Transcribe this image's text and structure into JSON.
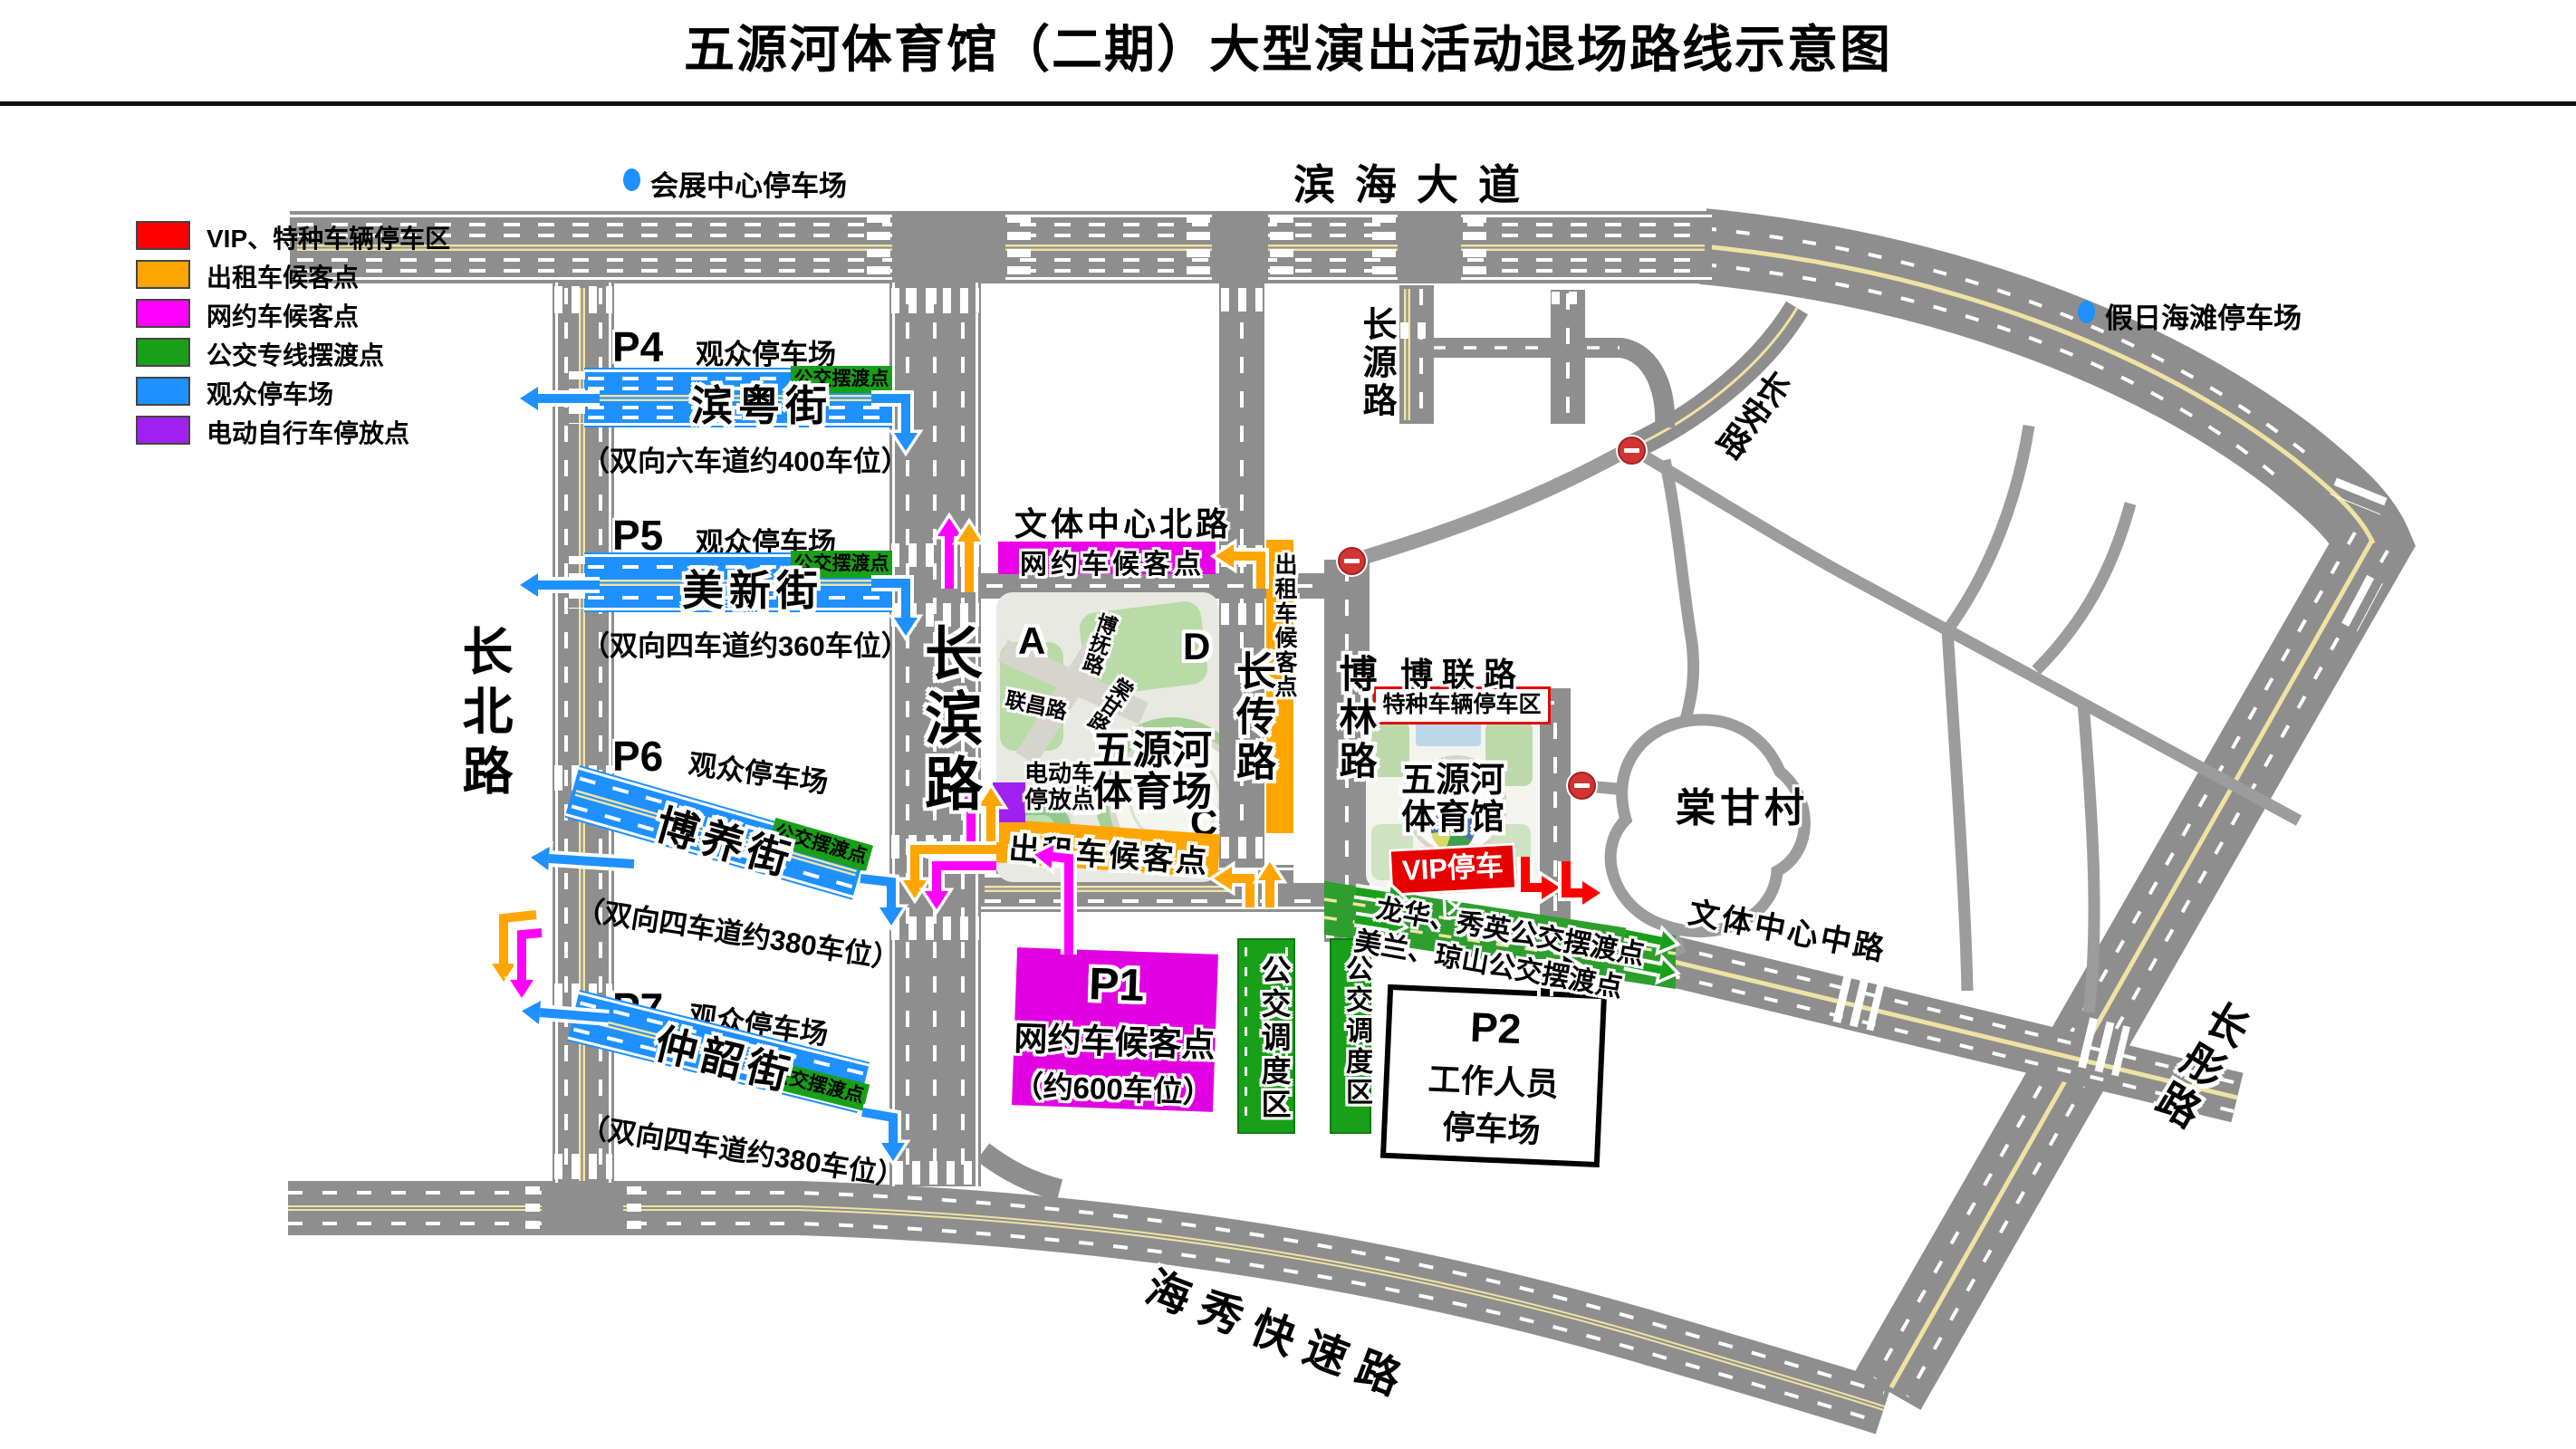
{
  "title": "五源河体育馆（二期）大型演出活动退场路线示意图",
  "colors": {
    "vip_red": "#ff0000",
    "taxi_orange": "#ffa500",
    "ridehail_magenta": "#ff00ff",
    "bus_green": "#18a018",
    "audience_blue": "#1e90ff",
    "ebike_purple": "#a020f0",
    "road_gray": "#8e8e8e"
  },
  "legend": {
    "items": [
      {
        "label": "VIP、特种车辆停车区",
        "color": "#ff0000"
      },
      {
        "label": "出租车候客点",
        "color": "#ffa500"
      },
      {
        "label": "网约车候客点",
        "color": "#ff00ff"
      },
      {
        "label": "公交专线摆渡点",
        "color": "#18a018"
      },
      {
        "label": "观众停车场",
        "color": "#1e90ff"
      },
      {
        "label": "电动自行车停放点",
        "color": "#a020f0"
      }
    ]
  },
  "offsite": {
    "expo": "会展中心停车场",
    "beach": "假日海滩停车场"
  },
  "roads": {
    "binhai": "滨海大道",
    "haixiu": "海秀快速路",
    "changbei": "长北路",
    "changbin": "长滨路",
    "changchuan": "长传路",
    "bolin": "博林路",
    "bolian": "博联路",
    "changyuan": "长源路",
    "changan": "长安路",
    "changtong": "长彤路",
    "wenti_north": "文体中心北路",
    "wenti_mid": "文体中心中路"
  },
  "village": "棠甘村",
  "stadium": {
    "name1": "五源河",
    "name2": "体育场",
    "gate_a": "A",
    "gate_b": "B",
    "gate_c": "C",
    "gate_d": "D",
    "road_bofu": "博抚路",
    "road_lianchang": "联昌路",
    "road_tanggan": "棠甘路",
    "ebike1": "电动车",
    "ebike2": "停放点",
    "taxi_bottom": "出租车候客点",
    "taxi_side": "出租车候客点",
    "ride_hail": "网约车候客点"
  },
  "gym": {
    "name1": "五源河",
    "name2": "体育馆",
    "special_zone": "特种车辆停车区",
    "vip_zone": "VIP停车区"
  },
  "shuttle": {
    "line1": "龙华、秀英公交摆渡点",
    "line2": "美兰、琼山公交摆渡点",
    "stop_label": "公交摆渡点"
  },
  "lots": {
    "p4": {
      "id": "P4",
      "type": "观众停车场",
      "street": "滨粤街",
      "capacity": "（双向六车道约400车位）"
    },
    "p5": {
      "id": "P5",
      "type": "观众停车场",
      "street": "美新街",
      "capacity": "（双向四车道约360车位）"
    },
    "p6": {
      "id": "P6",
      "type": "观众停车场",
      "street": "博养街",
      "capacity": "（双向四车道约380车位）"
    },
    "p7": {
      "id": "P7",
      "type": "观众停车场",
      "street": "仲韶街",
      "capacity": "（双向四车道约380车位）"
    },
    "p1": {
      "id": "P1",
      "name": "网约车候客点",
      "capacity": "（约600车位）"
    },
    "p2": {
      "id": "P2",
      "line1": "工作人员",
      "line2": "停车场"
    }
  },
  "bus_zone": "公交调度区"
}
